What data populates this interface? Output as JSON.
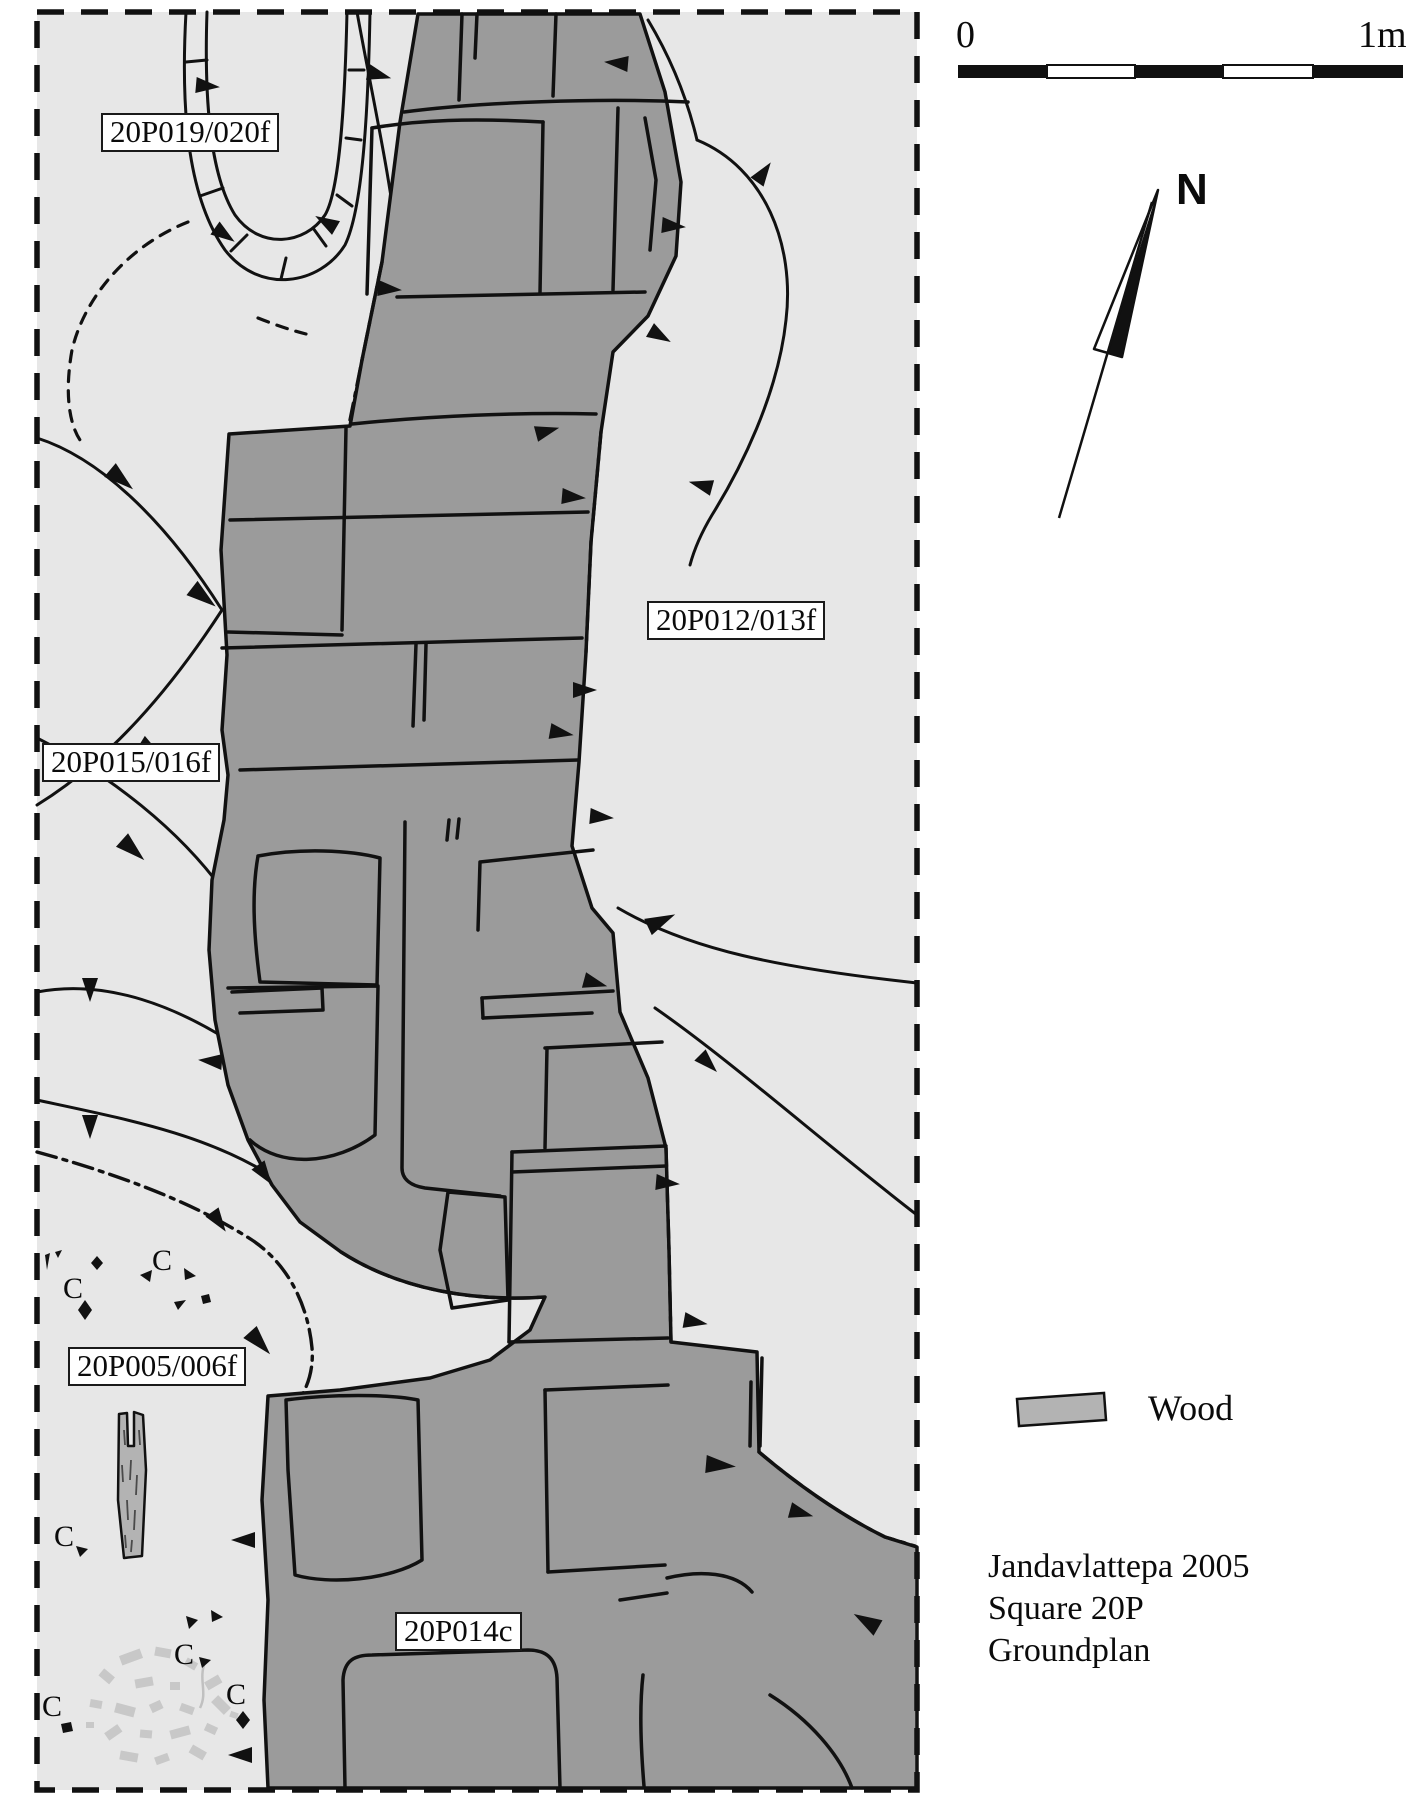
{
  "plan": {
    "feature_labels": [
      {
        "id": "20P019-020f",
        "text": "20P019/020f"
      },
      {
        "id": "20P012-013f",
        "text": "20P012/013f"
      },
      {
        "id": "20P015-016f",
        "text": "20P015/016f"
      },
      {
        "id": "20P005-006f",
        "text": "20P005/006f"
      },
      {
        "id": "20P014c",
        "text": "20P014c"
      }
    ],
    "charcoal_label": "C",
    "charcoal_count": 6
  },
  "scale_bar": {
    "zero_label": "0",
    "end_label": "1m",
    "length_meters": 1,
    "segments": 5
  },
  "north_arrow_label": "N",
  "legend": {
    "wood_label": "Wood",
    "wood_color": "#b3b3b3"
  },
  "caption": {
    "line1": "Jandavlattepa 2005",
    "line2": "Square 20P",
    "line3": "Groundplan"
  },
  "colors": {
    "survey_area_bg": "#e7e7e7",
    "platform_fill": "#9b9b9b",
    "outline": "#111111",
    "wood_fill": "#b3b3b3",
    "speckle": "#c8c8c8",
    "page_bg": "#ffffff"
  }
}
